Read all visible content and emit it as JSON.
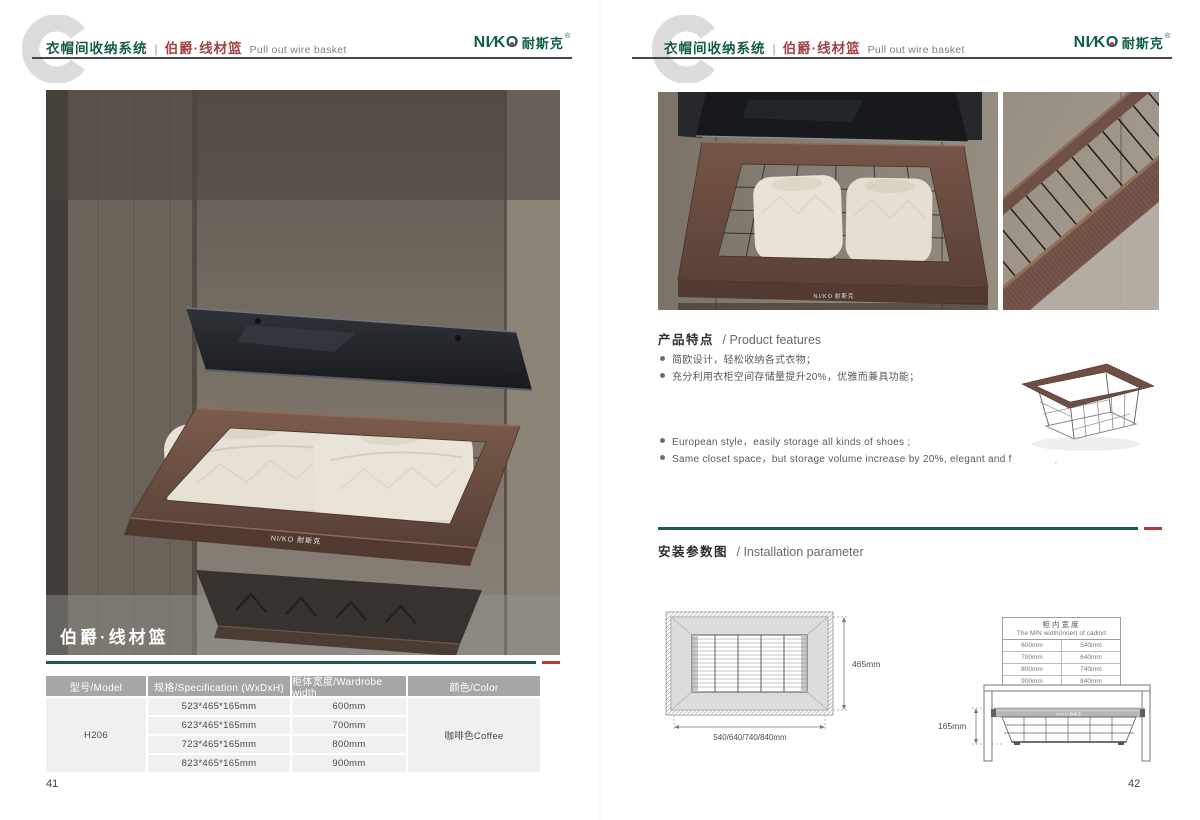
{
  "colors": {
    "brand_green": "#0d5f47",
    "header_green": "#155c47",
    "series_maroon": "#a04343",
    "rule_green": "#1a5c49",
    "accent_red": "#b23a3a",
    "table_header_bg": "#a6a6a6",
    "table_cell_bg": "#f0f0f0",
    "coffee_frame": "#6b4d42",
    "watermark_gray": "#dcdcdc"
  },
  "header": {
    "system_title": "衣帽间收纳系统",
    "divider": "|",
    "series_title": "伯爵·线材篮",
    "subtitle_en": "Pull out wire basket",
    "brand": {
      "latin_left": "NI∕K",
      "latin_o": "O",
      "cn": "耐斯克",
      "reg": "®"
    }
  },
  "left_page": {
    "page_number": "41",
    "photo_caption": "伯爵·线材篮",
    "spec_table": {
      "headers": [
        "型号/Model",
        "规格/Specification (WxDxH)",
        "柜体宽度/Wardrobe width",
        "颜色/Color"
      ],
      "model": "H206",
      "color": "咖啡色Coffee",
      "rows": [
        {
          "spec": "523*465*165mm",
          "width": "600mm"
        },
        {
          "spec": "623*465*165mm",
          "width": "700mm"
        },
        {
          "spec": "723*465*165mm",
          "width": "800mm"
        },
        {
          "spec": "823*465*165mm",
          "width": "900mm"
        }
      ]
    }
  },
  "right_page": {
    "page_number": "42",
    "features": {
      "title_cn": "产品特点",
      "title_en": "/ Product features",
      "bullets_cn": [
        "简欧设计，轻松收纳各式衣物；",
        "充分利用衣柜空间存储量提升20%，优雅而兼具功能；"
      ],
      "bullets_en": [
        "European style，easily storage all kinds of shoes ;",
        "Same closet space，but storage volume increase by 20%, elegant and functional;"
      ]
    },
    "installation": {
      "title_cn": "安装参数图",
      "title_en": "/ Installation parameter",
      "top_view": {
        "depth_label": "465mm",
        "width_label": "540/640/740/840mm"
      },
      "min_width_table": {
        "title_cn": "柜内宽度",
        "title_en": "The MIN width(inner) of cadinrt",
        "rows": [
          {
            "wardrobe": "600mm",
            "inner": "540mm"
          },
          {
            "wardrobe": "700mm",
            "inner": "640mm"
          },
          {
            "wardrobe": "800mm",
            "inner": "740mm"
          },
          {
            "wardrobe": "900mm",
            "inner": "840mm"
          }
        ]
      },
      "side_view": {
        "height_label": "165mm"
      }
    }
  }
}
